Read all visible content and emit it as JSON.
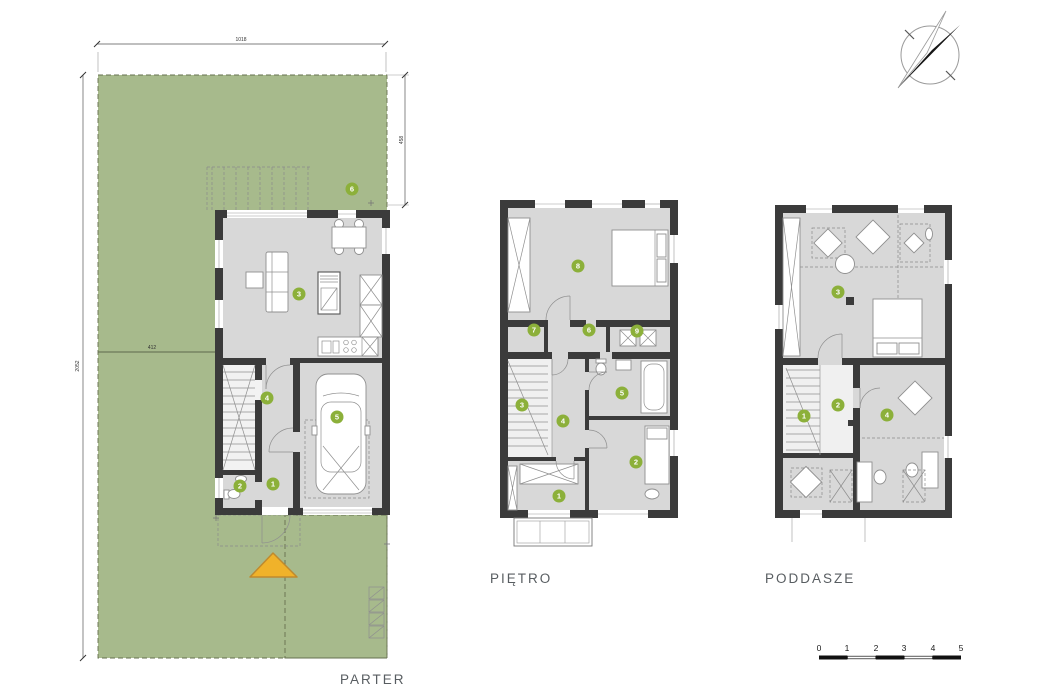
{
  "colors": {
    "plot_green": "#a7ba8c",
    "room_fill": "#d8d8d8",
    "wall": "#3b3b3b",
    "badge_green": "#8cb03a",
    "entrance_arrow": "#f0b22a",
    "entrance_arrow_border": "#bf8a2e"
  },
  "floors": {
    "parter": {
      "label": "PARTER",
      "rooms": [
        "1",
        "2",
        "3",
        "4",
        "5",
        "6"
      ]
    },
    "pietro": {
      "label": "PIĘTRO",
      "rooms": [
        "1",
        "2",
        "3",
        "4",
        "5",
        "6",
        "7",
        "8",
        "9"
      ]
    },
    "poddasze": {
      "label": "PODDASZE",
      "rooms": [
        "1",
        "2",
        "3",
        "4"
      ]
    }
  },
  "site_dimensions": {
    "top": "1018",
    "left": "2052",
    "right": "458",
    "middle": "412"
  },
  "scale_bar": {
    "ticks": [
      "0",
      "1",
      "2",
      "3",
      "4",
      "5"
    ]
  }
}
